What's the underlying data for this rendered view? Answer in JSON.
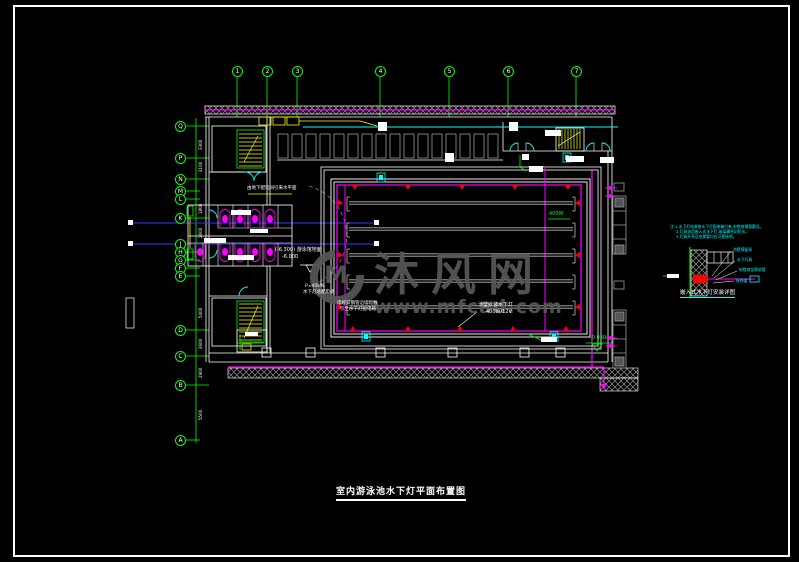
{
  "watermark": {
    "logo_text": "M",
    "site_name": "沐风网",
    "site_url": "www.mfcad.com"
  },
  "drawing_title": {
    "text": "室内游泳池水下灯平面布置图"
  },
  "detail": {
    "title": "嵌入式水下灯安装详图"
  },
  "grid": {
    "top": [
      {
        "label": "1",
        "x": 237
      },
      {
        "label": "2",
        "x": 267
      },
      {
        "label": "3",
        "x": 297
      },
      {
        "label": "4",
        "x": 380
      },
      {
        "label": "5",
        "x": 449
      },
      {
        "label": "6",
        "x": 508
      },
      {
        "label": "7",
        "x": 576
      }
    ],
    "left": [
      {
        "label": "Q",
        "y": 126
      },
      {
        "label": "P",
        "y": 158
      },
      {
        "label": "N",
        "y": 179
      },
      {
        "label": "M",
        "y": 191
      },
      {
        "label": "L",
        "y": 199
      },
      {
        "label": "K",
        "y": 218
      },
      {
        "label": "J",
        "y": 244
      },
      {
        "label": "H",
        "y": 252
      },
      {
        "label": "G",
        "y": 260
      },
      {
        "label": "F",
        "y": 268
      },
      {
        "label": "E",
        "y": 276
      },
      {
        "label": "D",
        "y": 330
      },
      {
        "label": "C",
        "y": 356
      },
      {
        "label": "B",
        "y": 385
      },
      {
        "label": "A",
        "y": 440
      }
    ]
  },
  "annotations": [
    {
      "name": "riser-note",
      "text": "由地下配电间引来水平面",
      "x": 247,
      "y": 186,
      "fs": 4.5
    },
    {
      "name": "pool-floor-elevation",
      "text": "(-6.300) 游泳馆地面",
      "x": 275,
      "y": 248,
      "fs": 5
    },
    {
      "name": "pool-floor-elevation-value",
      "text": "-6.000",
      "x": 282,
      "y": 255,
      "fs": 5
    },
    {
      "name": "panel-power",
      "text": "P=40kW",
      "x": 305,
      "y": 284,
      "fs": 4.5
    },
    {
      "name": "panel-name",
      "text": "水下灯总配电箱",
      "x": 303,
      "y": 290,
      "fs": 4.5
    },
    {
      "name": "cable-note-1",
      "text": "电缆穿钢管沿墙暗敷",
      "x": 337,
      "y": 301,
      "fs": 4.5
    },
    {
      "name": "cable-note-2",
      "text": "引至水下灯配电箱",
      "x": 340,
      "y": 307,
      "fs": 4.5
    },
    {
      "name": "underwater-light-note",
      "text": "池壁嵌装水下灯",
      "x": 478,
      "y": 303,
      "fs": 5
    },
    {
      "name": "underwater-light-spec",
      "text": "400W/12V",
      "x": 486,
      "y": 310,
      "fs": 5
    },
    {
      "name": "lamp-wattage",
      "text": "400W",
      "x": 549,
      "y": 212,
      "fs": 5,
      "color": "#00ff00"
    },
    {
      "name": "deck-elevation",
      "text": "-0.030",
      "x": 590,
      "y": 336,
      "fs": 5,
      "color": "#00ff00"
    },
    {
      "name": "detail-note-1",
      "text": "注:1.水下灯电源由水下灯配电箱引来,电缆穿钢管敷设。",
      "x": 670,
      "y": 225,
      "fs": 3.8,
      "color": "#00ffff"
    },
    {
      "name": "detail-note-2",
      "text": "2.灯具选用嵌入式水下灯,玻璃罩密封防水。",
      "x": 676,
      "y": 230,
      "fs": 3.8,
      "color": "#00ffff"
    },
    {
      "name": "detail-note-3",
      "text": "3.灯具外壳及金属管均应可靠接地。",
      "x": 676,
      "y": 235,
      "fs": 3.8,
      "color": "#00ffff"
    },
    {
      "name": "detail-label-niche",
      "text": "池壁预留洞",
      "x": 733,
      "y": 248,
      "fs": 3.8,
      "color": "#00ffff"
    },
    {
      "name": "detail-label-lamp",
      "text": "水下灯具",
      "x": 737,
      "y": 258,
      "fs": 3.8,
      "color": "#00ffff"
    },
    {
      "name": "detail-label-conduit",
      "text": "电缆穿金属软管",
      "x": 739,
      "y": 268,
      "fs": 3.8,
      "color": "#00ffff"
    },
    {
      "name": "detail-label-box",
      "text": "接线盒",
      "x": 736,
      "y": 279,
      "fs": 3.8,
      "color": "#00ffff"
    },
    {
      "name": "dimension-text",
      "text": "3300",
      "x": 199,
      "y": 150,
      "fs": 4,
      "rot": true
    },
    {
      "name": "dimension-text",
      "text": "2100",
      "x": 199,
      "y": 172,
      "fs": 4,
      "rot": true
    },
    {
      "name": "dimension-text",
      "text": "1800",
      "x": 199,
      "y": 214,
      "fs": 4,
      "rot": true
    },
    {
      "name": "dimension-text",
      "text": "2600",
      "x": 199,
      "y": 238,
      "fs": 4,
      "rot": true
    },
    {
      "name": "dimension-text",
      "text": "5400",
      "x": 199,
      "y": 318,
      "fs": 4,
      "rot": true
    },
    {
      "name": "dimension-text",
      "text": "2600",
      "x": 199,
      "y": 349,
      "fs": 4,
      "rot": true
    },
    {
      "name": "dimension-text",
      "text": "2900",
      "x": 199,
      "y": 378,
      "fs": 4,
      "rot": true
    },
    {
      "name": "dimension-text",
      "text": "5500",
      "x": 199,
      "y": 420,
      "fs": 4,
      "rot": true
    }
  ]
}
